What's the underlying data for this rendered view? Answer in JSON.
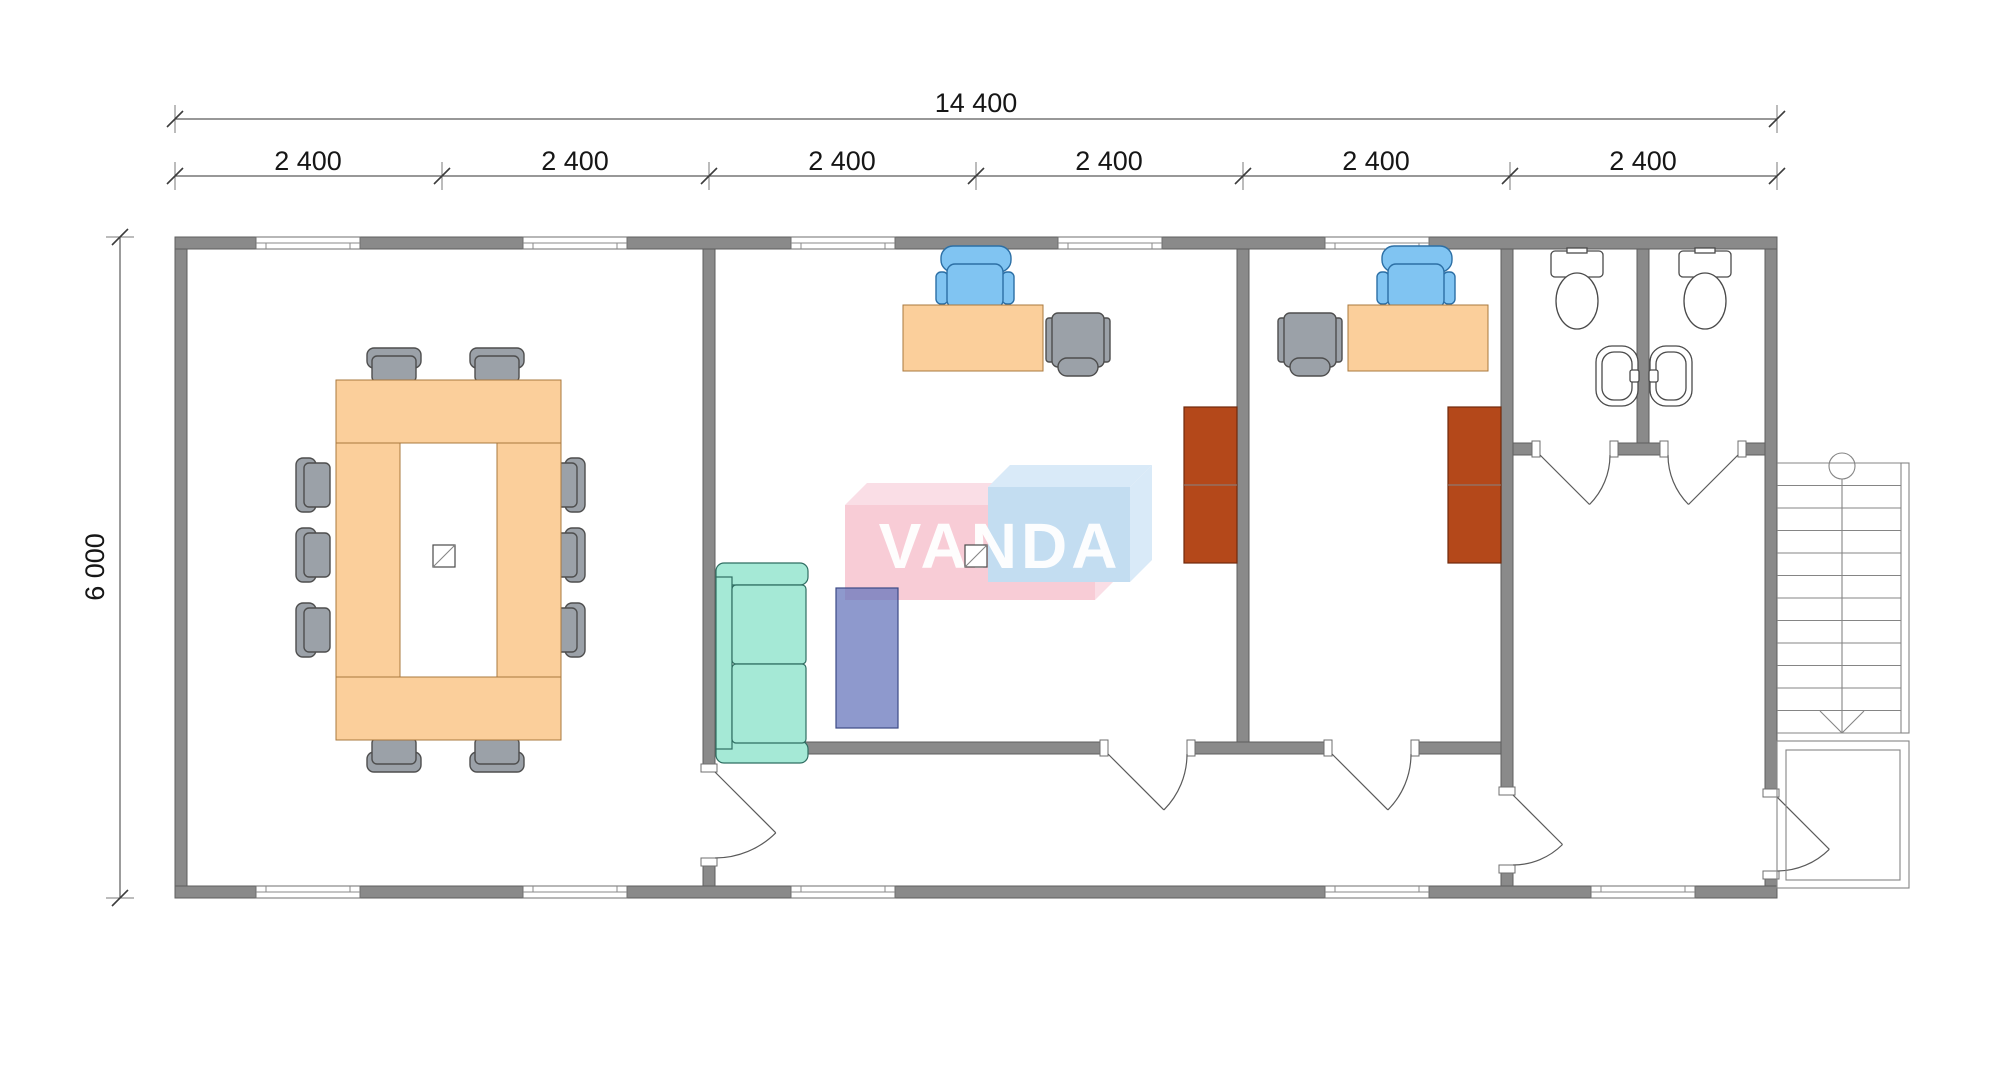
{
  "page": {
    "background": "#ffffff",
    "type": "architectural-floor-plan"
  },
  "dimensions": {
    "total_width_label": "14 400",
    "segment_labels": [
      "2 400",
      "2 400",
      "2 400",
      "2 400",
      "2 400",
      "2 400"
    ],
    "height_label": "6 000"
  },
  "watermark": {
    "text": "VANDA"
  },
  "colors": {
    "wall": "#8a8a8a",
    "wall_stroke": "#5f5f5f",
    "wood": "#fbcf9b",
    "wood_stroke": "#a9783e",
    "chair_gray": "#9ba1a8",
    "chair_stroke": "#4e4e4e",
    "office_chair_blue": "#80c4f2",
    "office_chair_stroke": "#2c6fa5",
    "sofa_teal": "#a5e9d6",
    "sofa_stroke": "#2f6e62",
    "rug_purple": "rgba(104,119,188,0.75)",
    "cabinet_brown": "#b4481a",
    "logo_pink": "#f8ccd6",
    "logo_pink_light": "#fadee6",
    "logo_blue": "#c3ddf1",
    "logo_blue_light": "#d9eaf8",
    "logo_text": "#ffffff"
  },
  "symbols": {
    "conference_table": "u-shaped-table-with-10-chairs",
    "office_desk": "desk-with-task-chair-and-guest-chair",
    "sofa": "two-seat-sofa",
    "rug": "purple-mat",
    "cabinet": "tall-cabinet",
    "toilet": "toilet-top-view",
    "sink": "wall-sink-top-view",
    "stairs": "straight-stair-down-arrow",
    "floor_box": "square-with-diagonal"
  }
}
